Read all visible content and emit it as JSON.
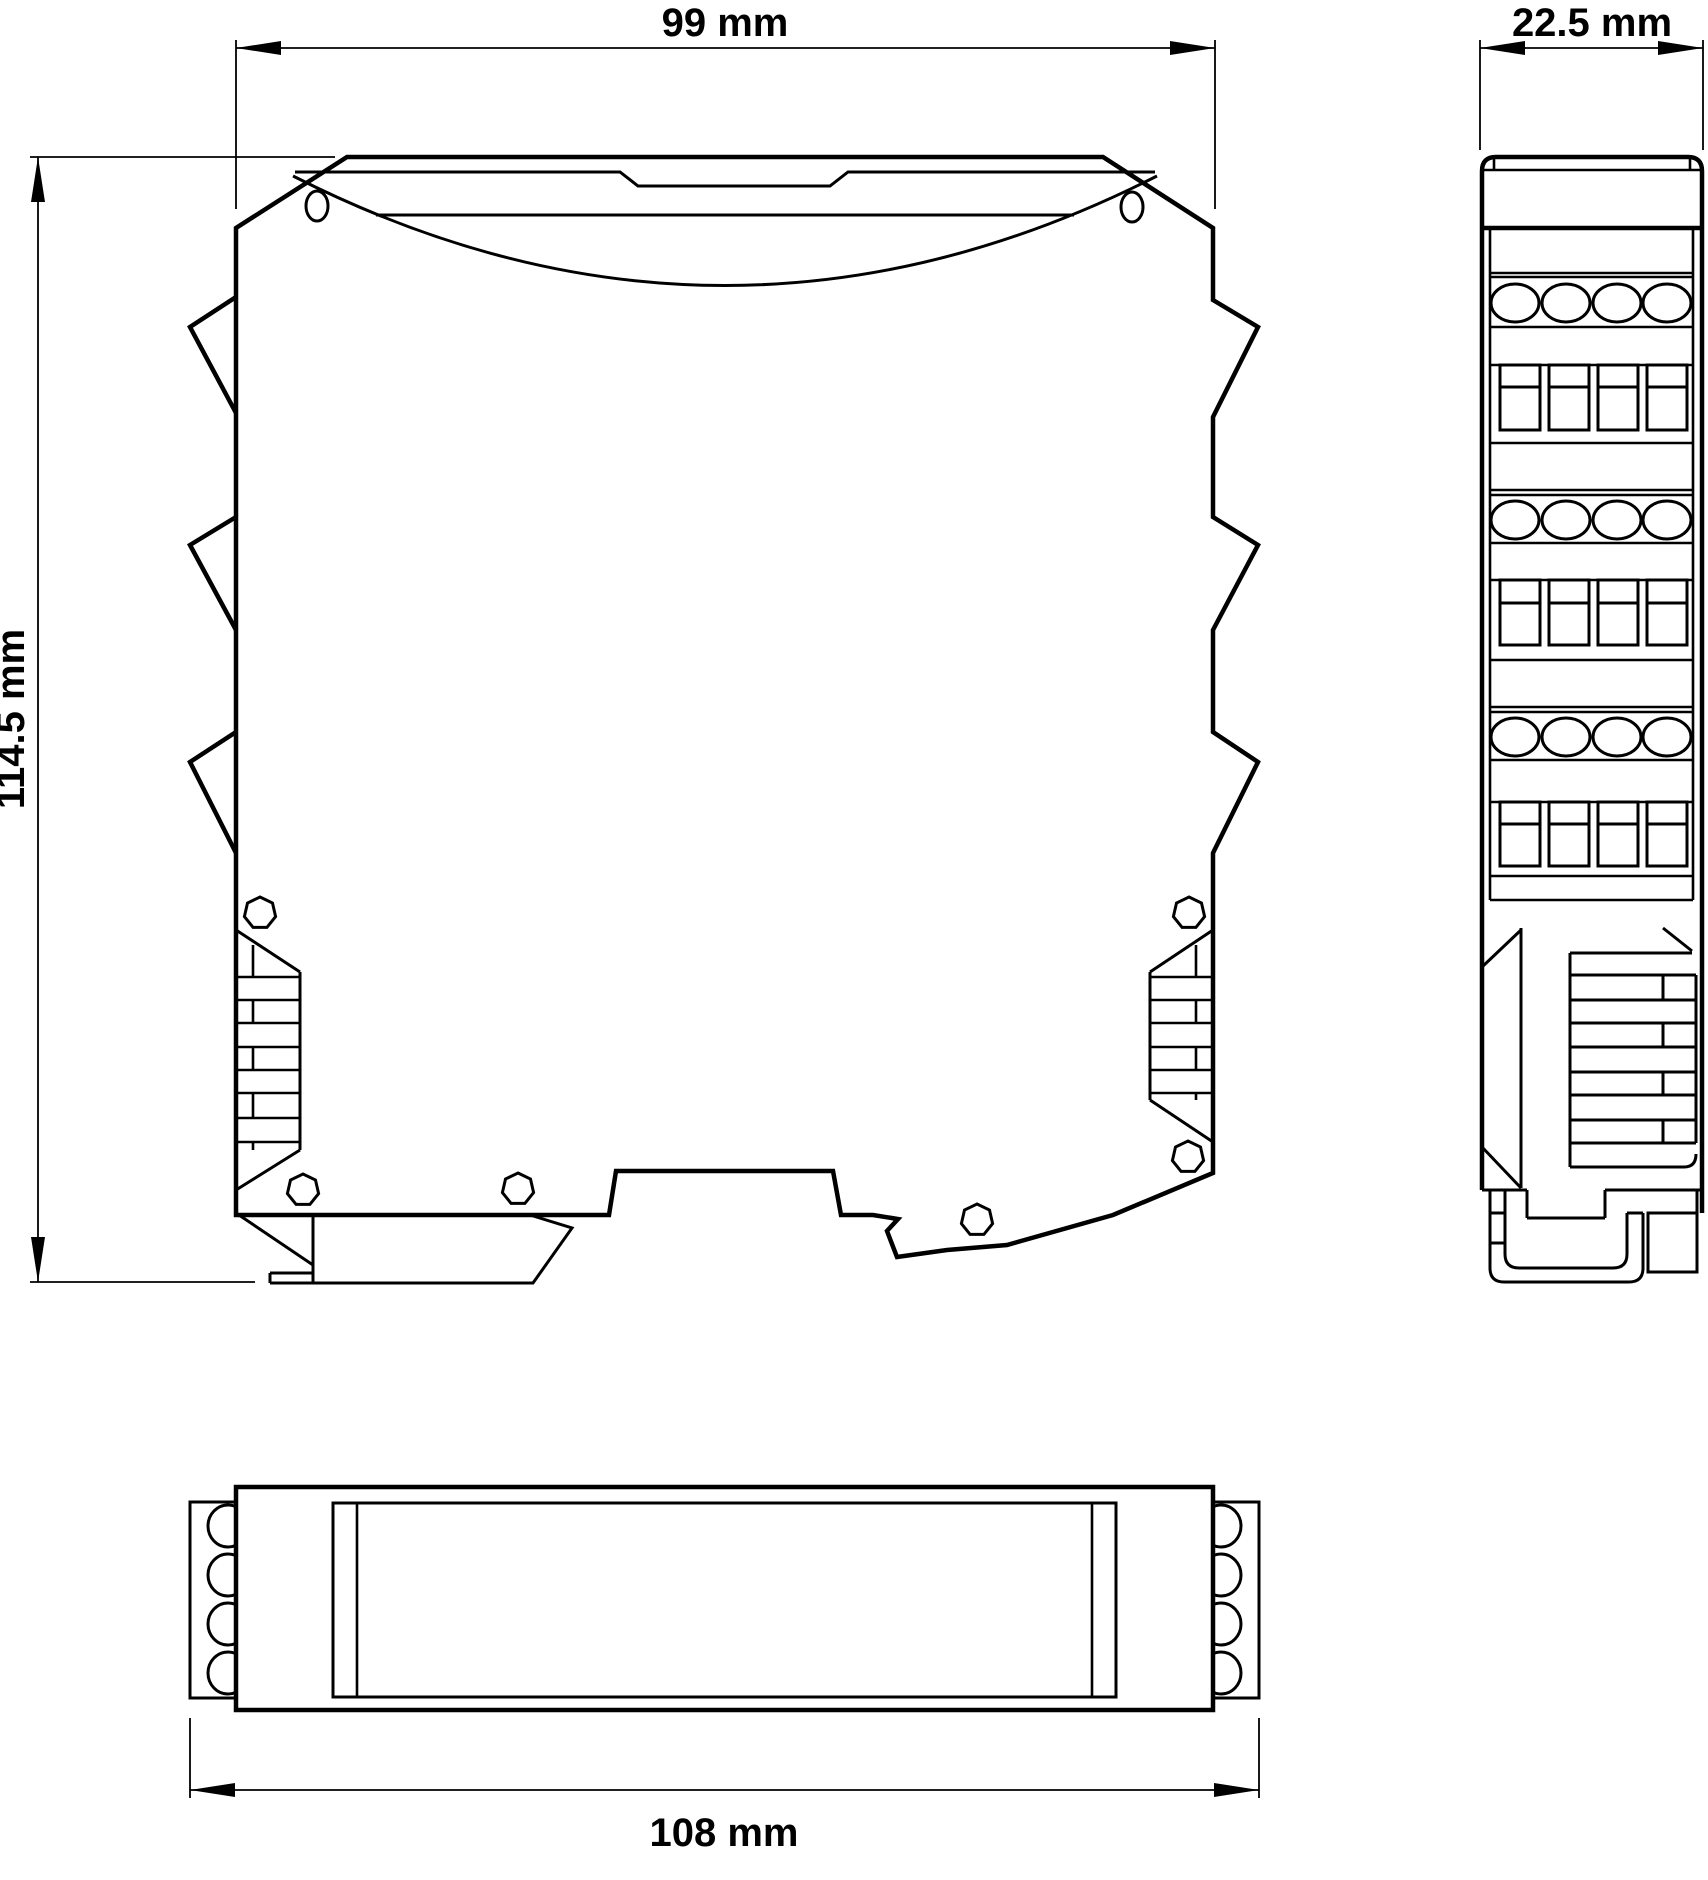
{
  "colors": {
    "line": "#000000",
    "background": "#ffffff"
  },
  "dimension_labels": {
    "front_width": "99 mm",
    "side_depth": "22.5 mm",
    "front_height": "114.5 mm",
    "bottom_length": "108 mm"
  }
}
